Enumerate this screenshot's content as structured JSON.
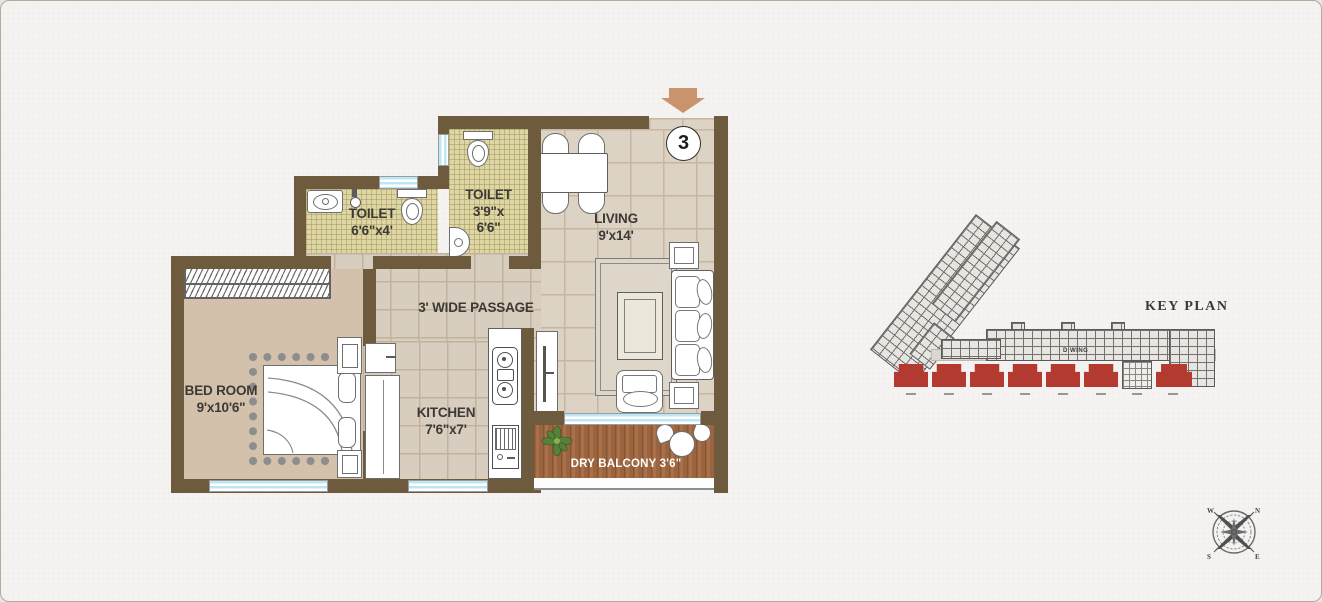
{
  "floor_plan": {
    "unit_number": "3",
    "rooms": {
      "toilet1": {
        "name": "TOILET",
        "dim": "6'6\"x4'"
      },
      "toilet2": {
        "name": "TOILET",
        "dim_line1": "3'9\"x",
        "dim_line2": "6'6\""
      },
      "living": {
        "name": "LIVING",
        "dim": "9'x14'"
      },
      "bedroom": {
        "name": "BED ROOM",
        "dim": "9'x10'6\""
      },
      "kitchen": {
        "name": "KITCHEN",
        "dim": "7'6\"x7'"
      },
      "passage": {
        "label": "3' WIDE PASSAGE"
      },
      "balcony": {
        "label": "DRY BALCONY 3'6\""
      }
    },
    "fixtures": [
      "entrance-arrow",
      "wardrobe",
      "double-bed",
      "nightstands",
      "sofa",
      "center-table",
      "rug",
      "armchair",
      "side-tables",
      "dining-table",
      "dining-chairs",
      "tv-unit",
      "kitchen-platform",
      "hob",
      "water-purifier",
      "wash-basin",
      "water-closet",
      "shower",
      "balcony-plant",
      "balcony-table-set"
    ]
  },
  "key_plan": {
    "title": "KEY PLAN",
    "wing_label": "D WING",
    "highlight_color": "#b23a31"
  },
  "compass": {
    "n": "N",
    "e": "E",
    "s": "S",
    "w": "W"
  },
  "colors": {
    "wall": "#6e5a3c",
    "window_glass": "#bde7f5",
    "entrance_arrow": "#c9946c",
    "balcony_wood": "#9a6440",
    "toilet_floor": "#ded7a5",
    "living_floor": "#ddd3c4",
    "bedroom_floor": "#d3c1ab",
    "keyplan_red": "#b23a31",
    "label_text": "#3d3934",
    "background": "#f4f3f1"
  }
}
